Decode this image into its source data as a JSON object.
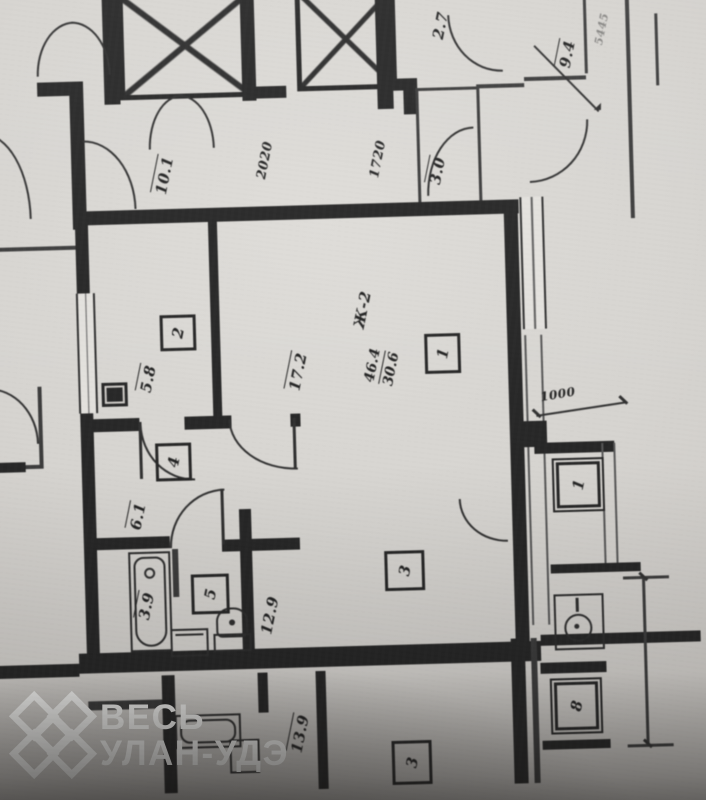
{
  "watermark": {
    "line1": "ВЕСЬ",
    "line2": "УЛАН-УДЭ",
    "logo": "ulzii-knot"
  },
  "labels": {
    "area_top_left": "10.1",
    "dim_2020": "2020",
    "dim_1720": "1720",
    "area_3_0": "3.0",
    "area_2_7": "2.7",
    "area_9_4": "9.4",
    "edge_text": "5445",
    "apartment_type": "Ж-2",
    "area_total": "46.4",
    "area_living": "30.6",
    "area_room1": "17.2",
    "area_room2": "5.8",
    "area_hall": "6.1",
    "area_bath": "3.9",
    "area_room3": "12.9",
    "area_bottom": "13.9",
    "dim_1000": "1000"
  },
  "room_numbers": {
    "r1": "1",
    "r2": "2",
    "r3": "3",
    "r4": "4",
    "r5": "5",
    "adj_right": "1",
    "adj_lower_right": "8",
    "lower_room": "3"
  }
}
